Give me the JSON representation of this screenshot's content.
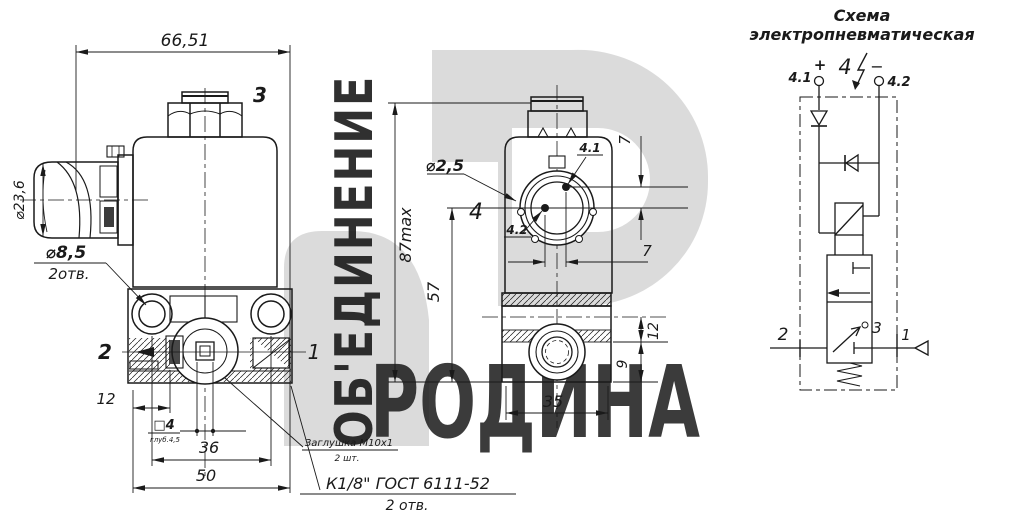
{
  "colors": {
    "line": "#1a1a1a",
    "watermark_shape": "#cdcdcd",
    "watermark_text": "#bfbfbf"
  },
  "watermark": {
    "vertical_text": "ОБ'ЕДИНЕНИЕ",
    "brand_text": "РОДИНА"
  },
  "left_view": {
    "dim_width": "66,51",
    "coil_label": "3",
    "dim_connector": "⌀23,6",
    "holes_label": "⌀8,5",
    "holes_qty": "2отв.",
    "port_left": "2",
    "port_right": "1",
    "dim_offset": "12",
    "square_label": "□4",
    "square_note": "глуб.4,5",
    "dim_holes_span": "36",
    "dim_base": "50",
    "plug_note": "Заглушка М10х1",
    "plug_qty": "2 шт.",
    "thread_note": "К1/8\" ГОСТ 6111-52",
    "thread_qty": "2 отв."
  },
  "front_view": {
    "dim_height": "87max",
    "dim_height2": "57",
    "pin_dia": "⌀2,5",
    "connector_label": "4",
    "pin1_label": "4.1",
    "pin2_label": "4.2",
    "dim_pin_vertical": "7",
    "dim_pin_horizontal": "7",
    "dim_port_top": "12",
    "dim_port_bottom": "9",
    "dim_base_width": "35"
  },
  "schematic": {
    "title_line1": "Схема",
    "title_line2": "электропневматическая",
    "pin1": "4.1",
    "plus": "+",
    "coil_label": "4",
    "minus": "−",
    "pin2": "4.2",
    "port_out": "2",
    "port_exhaust": "3",
    "port_in": "1"
  }
}
